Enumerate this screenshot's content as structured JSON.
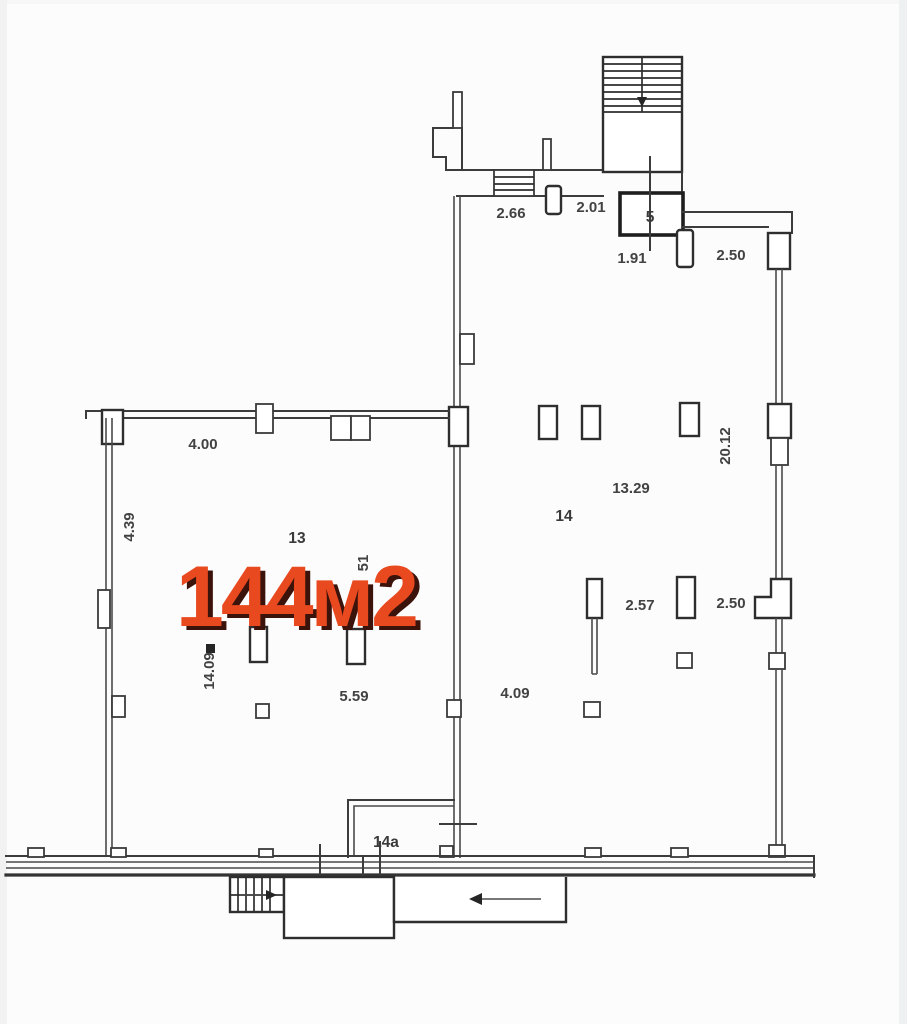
{
  "plan": {
    "area_label": "144м2",
    "rooms": {
      "r13": "13",
      "r14": "14",
      "r5": "5",
      "r14a": "14а"
    },
    "dims": {
      "d266": "2.66",
      "d201": "2.01",
      "d191": "1.91",
      "d250_top": "2.50",
      "d400": "4.00",
      "d439": "4.39",
      "d51": "51",
      "d1409": "14.09",
      "d559": "5.59",
      "d409": "4.09",
      "d1329": "13.29",
      "d2012": "20.12",
      "d257": "2.57",
      "d250_mid": "2.50"
    },
    "colors": {
      "accent": "#e8491f",
      "accent_shadow": "#3c130a",
      "wall": "#3c3c3c",
      "label": "#424242"
    },
    "icons": {
      "stairs_top": "stairs-hatch",
      "stairs_bottom": "stairs-hatch",
      "stair_direction": "▼",
      "entry_direction": "◄"
    }
  }
}
